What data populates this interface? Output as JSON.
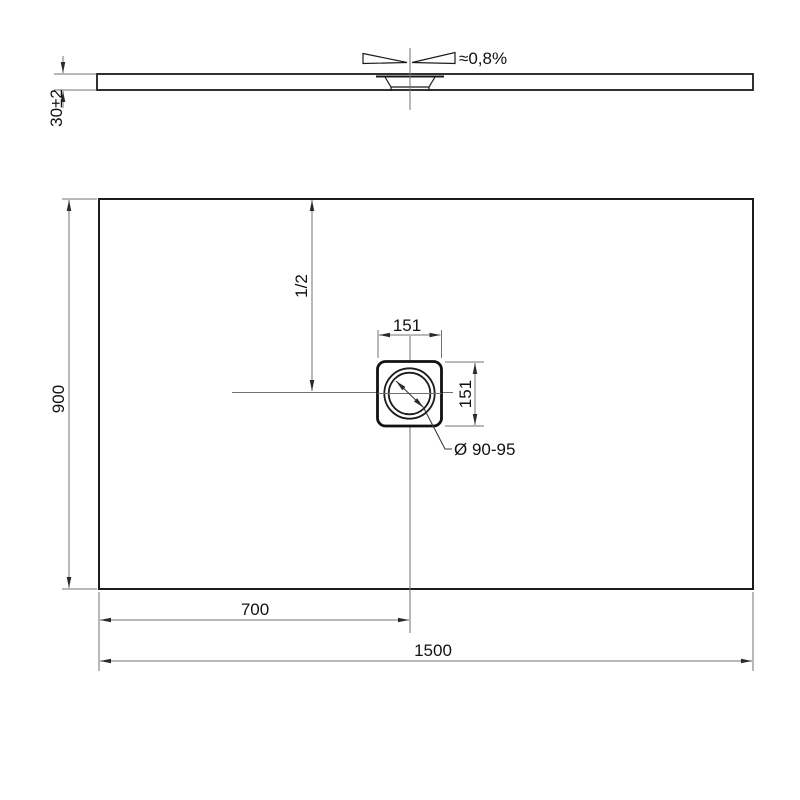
{
  "drawing": {
    "kind": "technical-dimension-drawing",
    "colors": {
      "object_line": "#1b1b1b",
      "dimension_line": "#707070",
      "text": "#111111",
      "background": "#ffffff"
    },
    "side_view": {
      "thickness_label": "30±2",
      "slope_label": "≈0,8%"
    },
    "plan_view": {
      "depth_label": "900",
      "half_center_label": "1/2",
      "drain_width_label": "151",
      "drain_height_label": "151",
      "drain_diameter_label": "Ø 90-95",
      "drain_offset_label": "700",
      "width_label": "1500"
    }
  }
}
